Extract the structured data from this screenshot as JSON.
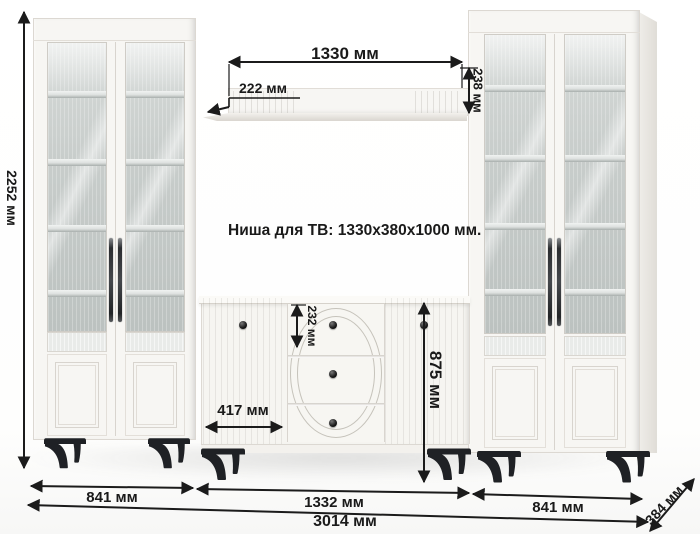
{
  "note": {
    "tv_niche": "Ниша для ТВ: 1330x380x1000 мм."
  },
  "dims": {
    "shelf_width": "1330 мм",
    "shelf_depth": "222 мм",
    "shelf_front_height": "238 мм",
    "total_height": "2252 мм",
    "sideboard_height": "875 мм",
    "drawer_height": "232 мм",
    "sideboard_door_width": "417 мм",
    "left_cabinet_width": "841 мм",
    "sideboard_width": "1332 мм",
    "right_cabinet_width": "841 мм",
    "total_width": "3014 мм",
    "unit_depth": "384 мм"
  },
  "colors": {
    "dimension_line": "#1b1b1b",
    "furniture_white": "#f7f6f3",
    "glass_gray": "#c8cdcb",
    "leg_black": "#1f2125"
  }
}
